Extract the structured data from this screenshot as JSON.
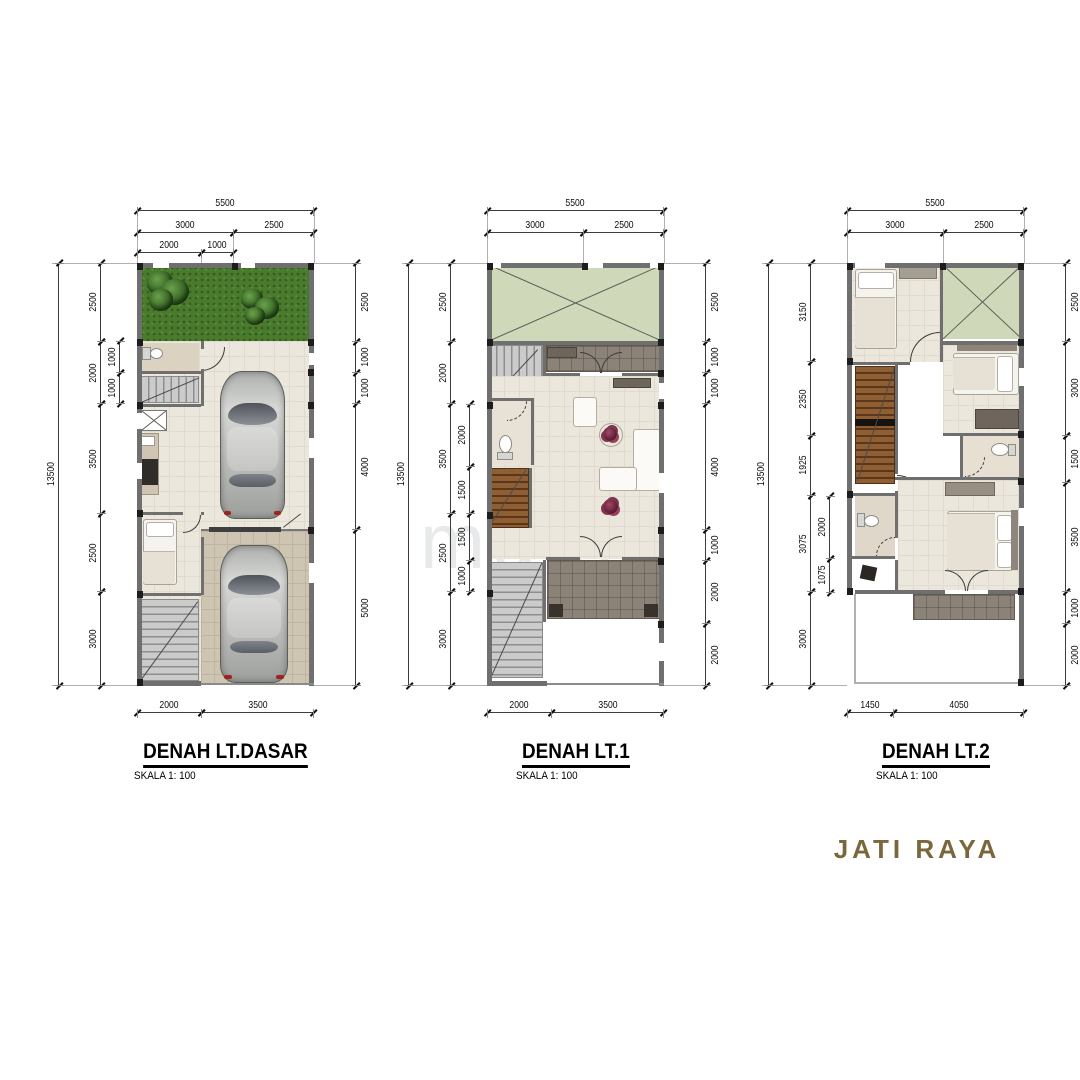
{
  "watermark": {
    "text": "maind"
  },
  "brand": {
    "label": "JATI RAYA",
    "color": "#7a683c"
  },
  "plans": [
    {
      "title": "DENAH LT.DASAR",
      "scale_label": "SKALA 1: 100",
      "dims": {
        "top_total": [
          "5500"
        ],
        "top_mid": [
          "3000",
          "2500"
        ],
        "top_inner": [
          "2000",
          "1000"
        ],
        "left_total": [
          "13500"
        ],
        "left_outer": [
          "2500",
          "2000",
          "3500",
          "2500",
          "3000"
        ],
        "left_inner": [
          "1000",
          "1000"
        ],
        "right": [
          "2500",
          "1000",
          "1000",
          "4000",
          "5000"
        ],
        "bottom": [
          "2000",
          "3500"
        ]
      }
    },
    {
      "title": "DENAH LT.1",
      "scale_label": "SKALA 1: 100",
      "dims": {
        "top_total": [
          "5500"
        ],
        "top_mid": [
          "3000",
          "2500"
        ],
        "left_total": [
          "13500"
        ],
        "left_outer": [
          "2500",
          "2000",
          "3500",
          "2500",
          "3000"
        ],
        "left_inner": [
          "2000",
          "1500",
          "1500",
          "1000"
        ],
        "right": [
          "2500",
          "1000",
          "1000",
          "4000",
          "1000",
          "2000",
          "2000"
        ],
        "bottom": [
          "2000",
          "3500"
        ]
      }
    },
    {
      "title": "DENAH LT.2",
      "scale_label": "SKALA 1: 100",
      "dims": {
        "top_total": [
          "5500"
        ],
        "top_mid": [
          "3000",
          "2500"
        ],
        "left_total": [
          "13500"
        ],
        "left_outer": [
          "3150",
          "2350",
          "1925",
          "3075",
          "3000"
        ],
        "left_inner": [
          "2000",
          "1075"
        ],
        "right": [
          "2500",
          "3000",
          "1500",
          "3500",
          "1000",
          "2000"
        ],
        "bottom": [
          "1450",
          "4050"
        ]
      }
    }
  ]
}
